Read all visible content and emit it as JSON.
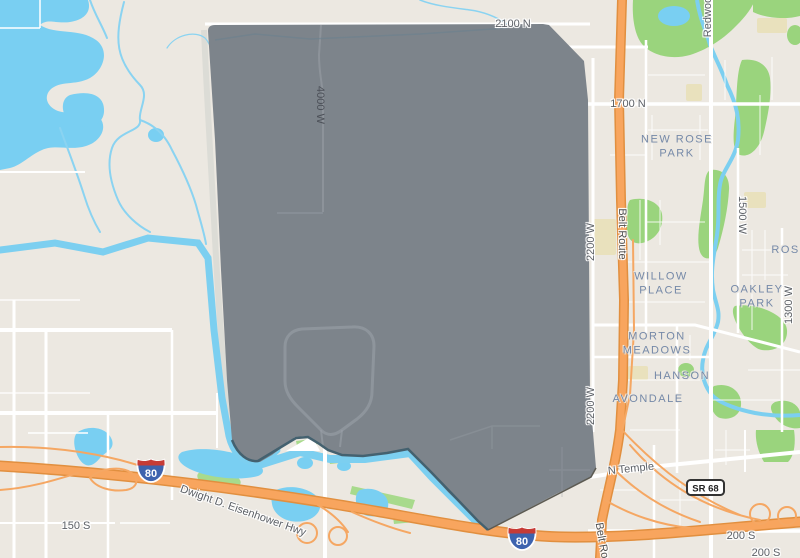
{
  "map": {
    "street_labels": {
      "n2100": "2100 N",
      "n1700": "1700 N",
      "w4000": "4000 W",
      "w2200_a": "2200 W",
      "w2200_b": "2200 W",
      "belt_route_a": "Belt Route",
      "belt_route_b": "Belt Route",
      "redwood": "Redwood",
      "w1500": "1500 W",
      "w1300": "1300 W",
      "n_temple": "N Temple",
      "s200_a": "200 S",
      "s200_b": "200 S",
      "s150": "150 S",
      "eisenhower": "Dwight D. Eisenhower Hwy"
    },
    "neighborhood_labels": {
      "new_rose_park": "NEW ROSE PARK",
      "willow_place": "WILLOW PLACE",
      "oakley_park": "OAKLEY PARK",
      "rose": "ROSE",
      "morton_meadows": "MORTON MEADOWS",
      "avondale": "AVONDALE",
      "hanson": "HANSON"
    },
    "shields": {
      "i80_a": "80",
      "i80_b": "80",
      "sr68": "SR 68"
    },
    "colors": {
      "land": "#ece8e1",
      "water": "#79cff2",
      "park_green": "#9ad47d",
      "golf_green": "#a8da8c",
      "highway_orange": "#f8a55e",
      "highway_casing": "#e18f3f",
      "road_white": "#ffffff",
      "selection_polygon_gray": "#7d848b",
      "boundary_river_dark": "#44616f",
      "school_tan": "#e9e1bd",
      "interstate_blue": "#3e63ae",
      "interstate_red": "#c63b36",
      "street_label_gray": "#5d6167",
      "neighborhood_label_blue": "#7589a8"
    }
  }
}
